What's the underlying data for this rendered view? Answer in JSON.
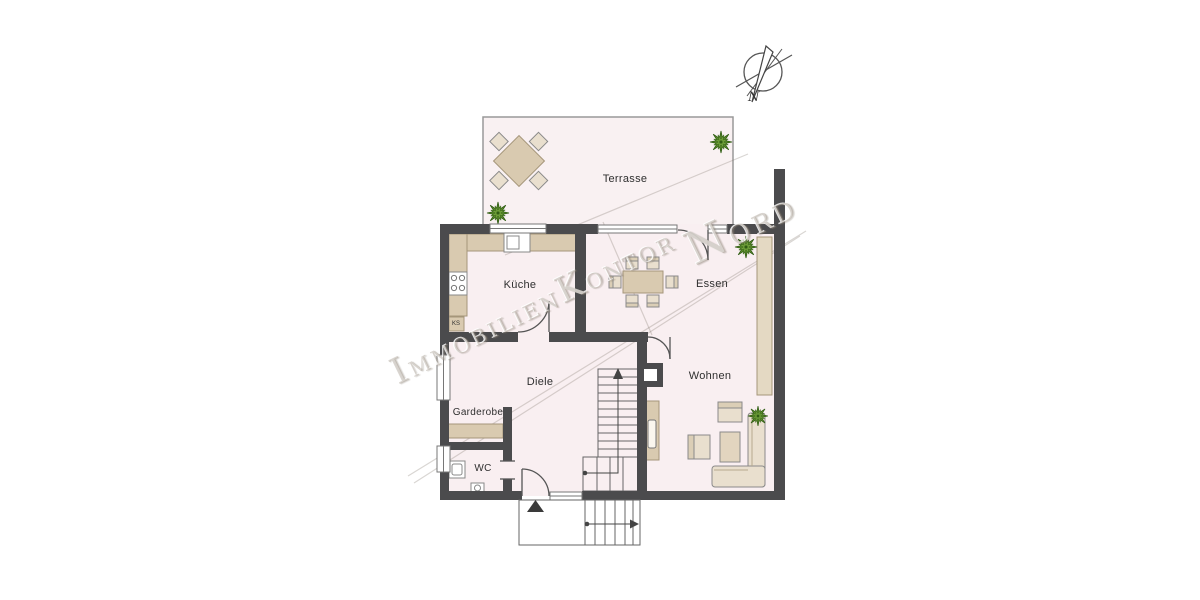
{
  "floorplan": {
    "rooms": {
      "terrasse": "Terrasse",
      "kueche": "Küche",
      "essen": "Essen",
      "diele": "Diele",
      "wohnen": "Wohnen",
      "garderobe": "Garderobe",
      "wc": "WC",
      "ks": "KS"
    },
    "compass": {
      "north": "N"
    },
    "watermark": {
      "i1": "I",
      "w1": "MMOBILIEN",
      "i2": "K",
      "w2": "ONTOR",
      "i3": "N",
      "w3": "ORD"
    },
    "colors": {
      "wall": "#4b4b4d",
      "floor": "#f9eff1",
      "terrace_floor": "#f9f1f2",
      "furniture": "#d9cab0",
      "furniture_light": "#e9dfce",
      "plant_green": "#5a8a2a",
      "plant_green_dark": "#3f6b1f",
      "watermark_gray": "#a89e92"
    }
  }
}
